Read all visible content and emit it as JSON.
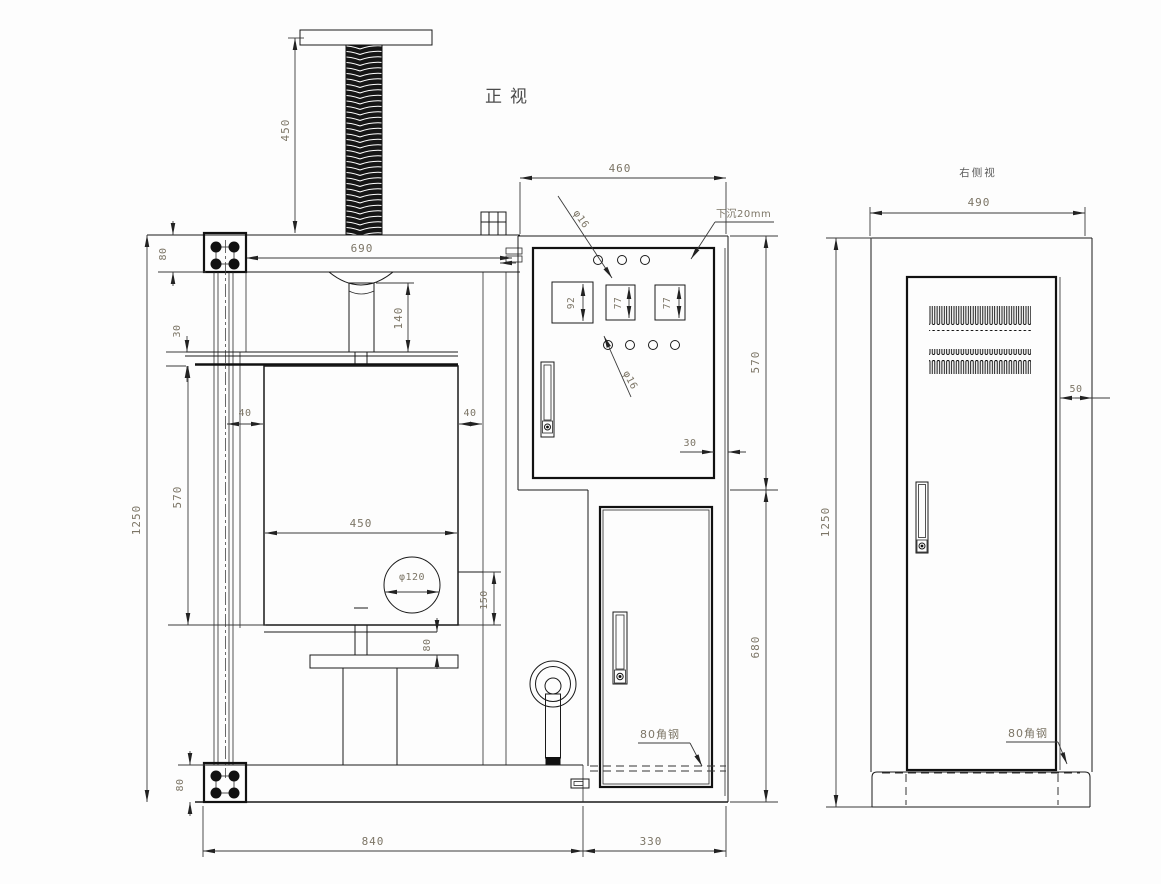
{
  "front_view": {
    "title": "正视",
    "dim_screw_height": "450",
    "dim_beam_width": "690",
    "dim_beam_height": "80",
    "dim_shelf_thickness": "30",
    "dim_overall_height": "1250",
    "dim_chamber_height": "570",
    "dim_gap_left": "40",
    "dim_gap_right": "40",
    "dim_ram_height": "140",
    "dim_chamber_width": "450",
    "dim_hole_diameter": "φ120",
    "dim_step_height": "150",
    "dim_pedestal_step": "80",
    "dim_base_height": "80",
    "dim_base_width": "840",
    "dim_cabinet_width": "330",
    "label_angle_steel": "80角钢"
  },
  "control_panel": {
    "dim_width": "460",
    "note_recessed": "下沉20mm",
    "dim_hole_top": "φ16",
    "dim_meter1_height": "92",
    "dim_meter2_height": "77",
    "dim_meter3_height": "77",
    "dim_hole_bottom": "φ16",
    "dim_edge_gap": "30",
    "dim_panel_height": "570",
    "dim_lower_height": "680"
  },
  "side_view": {
    "title": "右侧视",
    "dim_width": "490",
    "dim_door_gap": "50",
    "dim_overall_height": "1250",
    "label_angle_steel": "80角钢"
  }
}
